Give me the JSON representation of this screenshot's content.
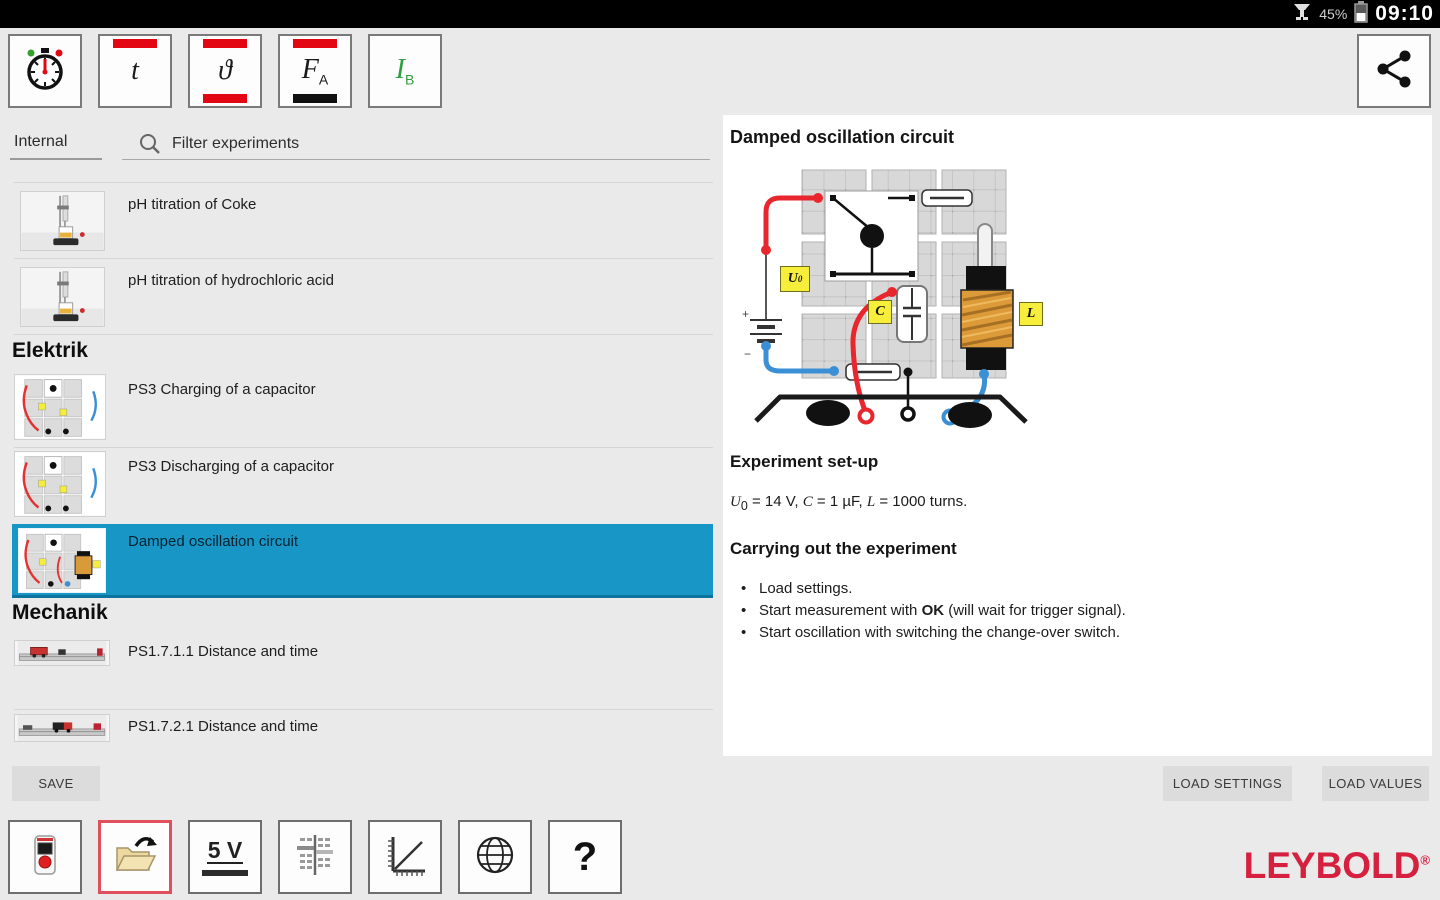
{
  "status_bar": {
    "time": "09:10",
    "battery_percent": "45%"
  },
  "topbar": {
    "quantity_t": {
      "main": "t"
    },
    "quantity_theta": {
      "main": "ϑ"
    },
    "quantity_fa": {
      "main": "F",
      "sub": "A"
    },
    "quantity_ib": {
      "main": "I",
      "sub": "B"
    }
  },
  "left_panel": {
    "tab_label": "Internal",
    "filter_placeholder": "Filter experiments",
    "rows": [
      {
        "label": "pH titration of Coke"
      },
      {
        "label": "pH titration of hydrochloric acid"
      },
      {
        "label": "Elektrik"
      },
      {
        "label": "PS3 Charging of a capacitor"
      },
      {
        "label": "PS3 Discharging of a capacitor"
      },
      {
        "label": "Damped oscillation circuit"
      },
      {
        "label": "Mechanik"
      },
      {
        "label": "PS1.7.1.1 Distance and time"
      },
      {
        "label": "PS1.7.2.1 Distance and time"
      }
    ],
    "save_label": "SAVE"
  },
  "bottom_toolbar": {
    "voltage_label": "5 V",
    "help_label": "?"
  },
  "detail": {
    "title": "Damped oscillation circuit",
    "circuit_labels": {
      "u_main": "U",
      "u_sub": "0",
      "c": "C",
      "l": "L"
    },
    "setup_heading": "Experiment set-up",
    "setup": {
      "var_u": "U",
      "sub_u": "0",
      "seg1": " = 14 V, ",
      "var_c": "C",
      "seg2": " = 1 µF, ",
      "var_l": "L",
      "seg3": " = 1000 turns."
    },
    "carrying_heading": "Carrying out the experiment",
    "bullets": [
      {
        "pre": "Load settings."
      },
      {
        "pre": "Start measurement with ",
        "bold": "OK",
        "post": " (will wait for trigger signal)."
      },
      {
        "pre": "Start oscillation with switching the change-over switch."
      }
    ],
    "load_settings_label": "LOAD SETTINGS",
    "load_values_label": "LOAD VALUES"
  },
  "brand": {
    "name": "LEYBOLD",
    "registered": "®"
  },
  "colors": {
    "accent_red": "#e30613",
    "selected_blue": "#1896c5",
    "brand_red": "#d5213f",
    "label_yellow": "#f7ee3b"
  }
}
